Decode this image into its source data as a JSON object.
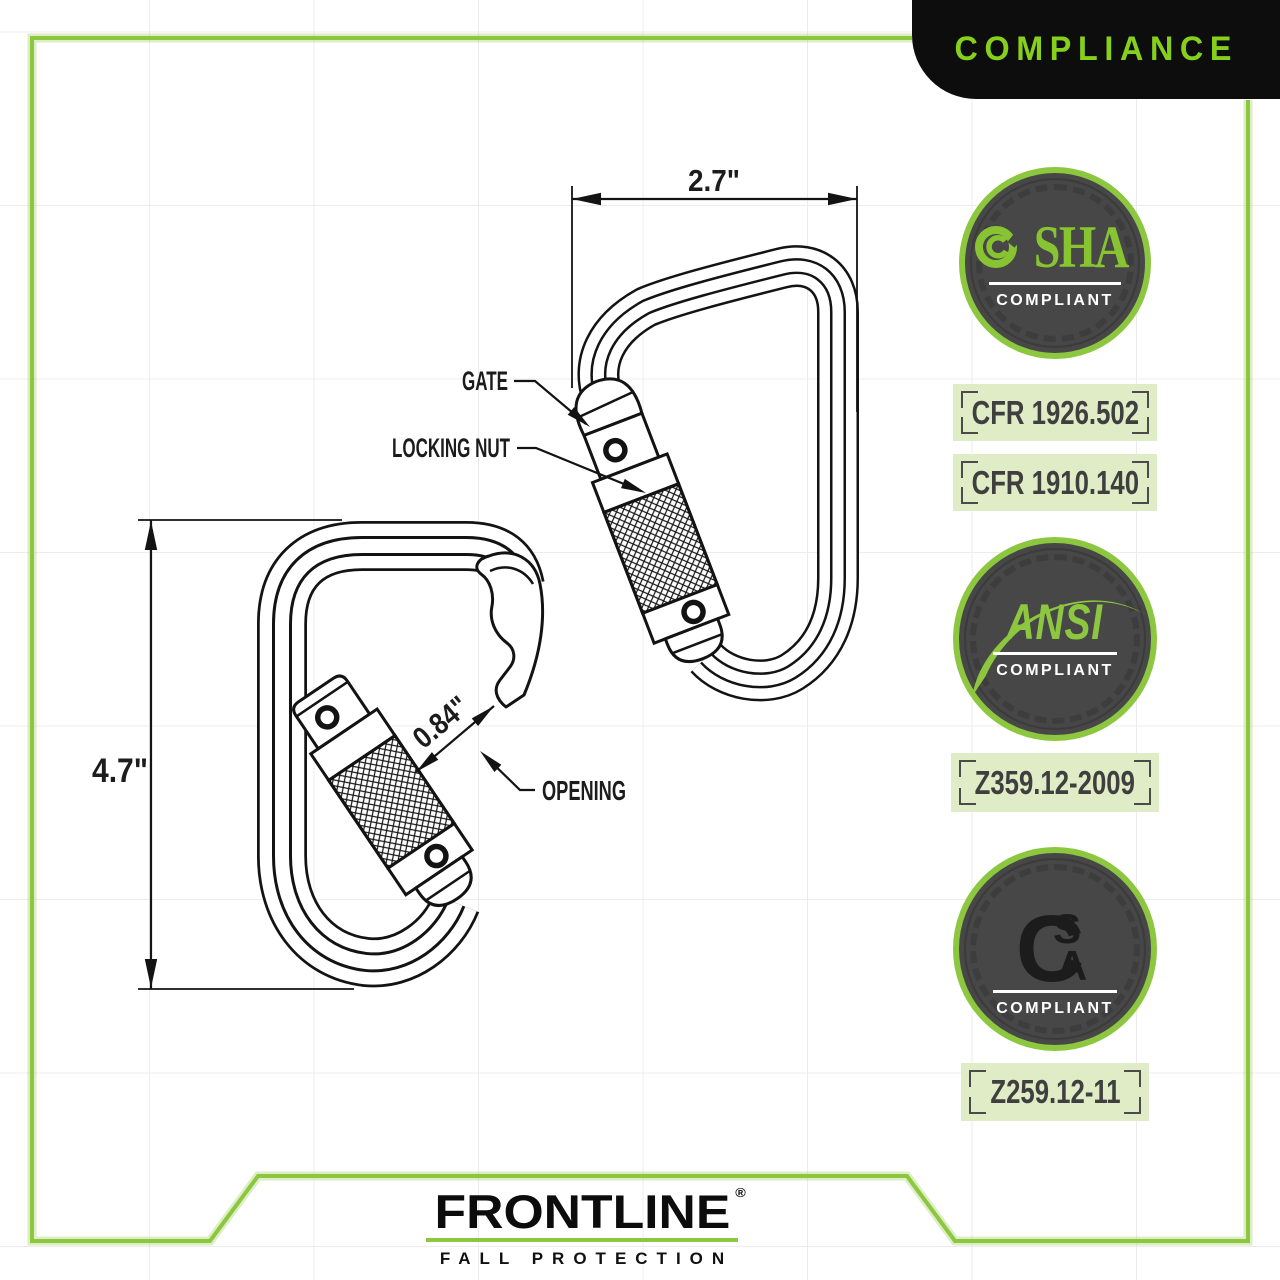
{
  "banner": {
    "title": "COMPLIANCE"
  },
  "diagram": {
    "labels": {
      "gate": "GATE",
      "locking_nut": "LOCKING NUT",
      "opening": "OPENING"
    },
    "dimensions": {
      "width": "2.7\"",
      "height": "4.7\"",
      "opening": "0.84\""
    }
  },
  "compliance": {
    "osha": {
      "org": "OSHA",
      "org_rest": "SHA",
      "status": "COMPLIANT",
      "codes": [
        "CFR 1926.502",
        "CFR 1910.140"
      ]
    },
    "ansi": {
      "org": "ANSI",
      "status": "COMPLIANT",
      "codes": [
        "Z359.12-2009"
      ]
    },
    "csa": {
      "org": "CSA",
      "logo_c": "C",
      "logo_s": "S",
      "logo_a": "A",
      "status": "COMPLIANT",
      "codes": [
        "Z259.12-11"
      ]
    }
  },
  "footer": {
    "brand": "FRONTLINE",
    "registered": "®",
    "tagline": "FALL PROTECTION"
  },
  "colors": {
    "accent_green": "#8dc63f",
    "banner_text_green": "#86d01c",
    "label_background": "#dfecc5",
    "badge_gray": "#474747",
    "banner_black": "#0d0d0d",
    "line_ink": "#131313"
  }
}
